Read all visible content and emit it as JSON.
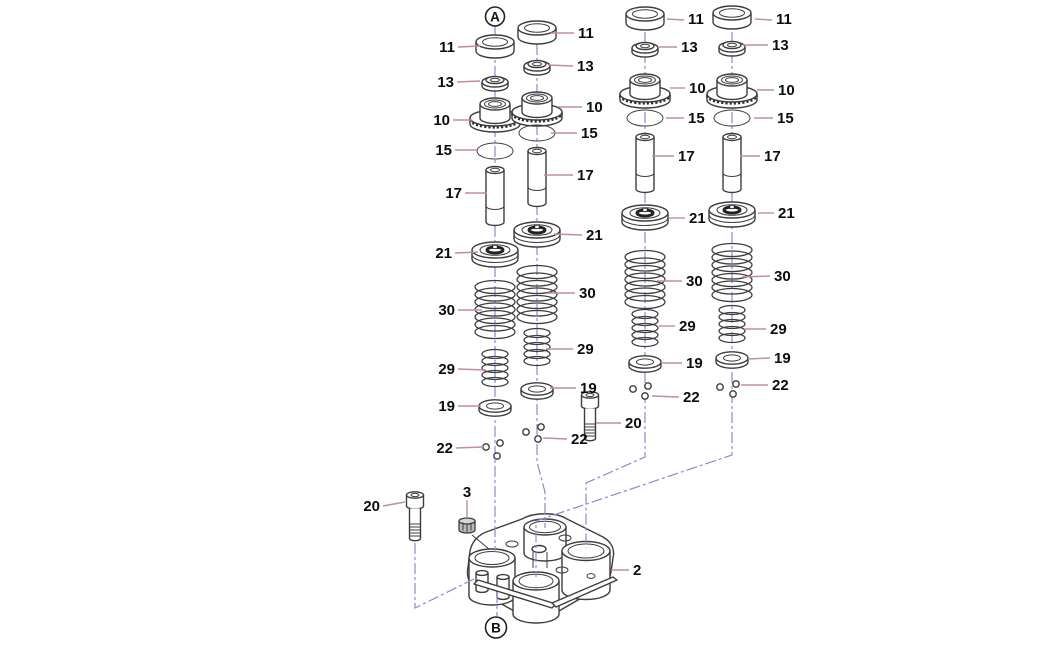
{
  "diagram": {
    "markers": {
      "top": "A",
      "bottom": "B"
    },
    "callouts": {
      "cap": "11",
      "seal": "13",
      "spring_seat": "10",
      "o_ring": "15",
      "lifter": "17",
      "retainer": "21",
      "outer_spring": "30",
      "inner_spring": "29",
      "washer": "19",
      "keepers": "22",
      "bolt": "20",
      "plug": "3",
      "housing": "2"
    },
    "colors": {
      "leader_line": "#c48d97",
      "center_line": "#8a8ace",
      "part_outline": "#3d3d3d",
      "label_text": "#0d0d0d",
      "background": "#ffffff"
    }
  }
}
